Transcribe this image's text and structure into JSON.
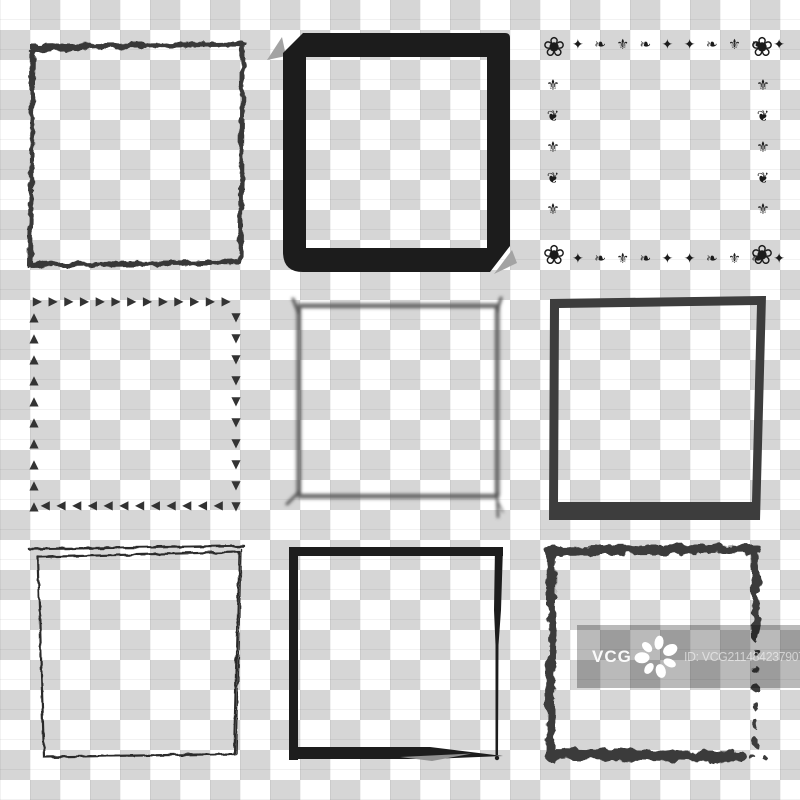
{
  "canvas": {
    "width": 800,
    "height": 800
  },
  "background": {
    "type": "transparency-checkerboard",
    "square_size_px": 30,
    "light": "#ffffff",
    "dark": "#d6d6d6"
  },
  "watermark": {
    "brand": "VCG",
    "id_label": "ID: VCG211484237907",
    "overlay_color": "rgba(0,0,0,0.27)",
    "logo_icon": "flower-asterisk-icon",
    "text_color": "#ffffff"
  },
  "frames": {
    "grid": {
      "rows": 3,
      "cols": 3
    },
    "items": [
      {
        "name": "grunge-thin-square-frame",
        "row": 1,
        "col": 1,
        "color": "#383838",
        "stroke_px": 5
      },
      {
        "name": "thick-marker-square-frame",
        "row": 1,
        "col": 2,
        "color": "#1c1c1c",
        "stroke_px": 22,
        "accent": "#a3a3a3"
      },
      {
        "name": "ornamental-floral-square-frame",
        "row": 1,
        "col": 3,
        "color": "#1b1b1b",
        "corner_glyph": "❀",
        "horizontal_pattern": "✦ ❧ ⚜ ❧ ✦ ✦ ❧ ⚜ ❧ ✦",
        "vertical_pattern": "⚜❦⚜❦⚜"
      },
      {
        "name": "triangle-dashed-square-frame",
        "row": 2,
        "col": 1,
        "color": "#333333",
        "top": "▶▶▶▶▶▶▶▶▶▶▶▶▶",
        "right": "▼▼▼▼▼▼▼▼▼▼",
        "bottom": "◀◀◀◀◀◀◀◀◀◀◀◀",
        "left": "▲▲▲▲▲▲▲▲▲▲"
      },
      {
        "name": "blurred-brush-square-frame",
        "row": 2,
        "col": 2,
        "color": "#6a6a6a",
        "core_color": "#474747",
        "stroke_px": 5,
        "effect": "gaussian-blur"
      },
      {
        "name": "solid-skewed-square-frame",
        "row": 2,
        "col": 3,
        "color": "#3d3d3d",
        "stroke_px": 9,
        "bottom_stroke_px": 18
      },
      {
        "name": "pencil-sketch-square-frame",
        "row": 3,
        "col": 1,
        "color": "#2c2c2c",
        "stroke_px": 2,
        "detail": "double tapered top stroke"
      },
      {
        "name": "bold-brush-square-frame",
        "row": 3,
        "col": 2,
        "color": "#1d1d1d",
        "stroke_px": 9,
        "accent": "#909090",
        "detail": "tapered brush tail at bottom-right"
      },
      {
        "name": "grunge-bold-square-frame",
        "row": 3,
        "col": 3,
        "color": "#3b3b3b",
        "stroke_px": 9,
        "detail": "lower right edge breaks into dots"
      }
    ]
  }
}
